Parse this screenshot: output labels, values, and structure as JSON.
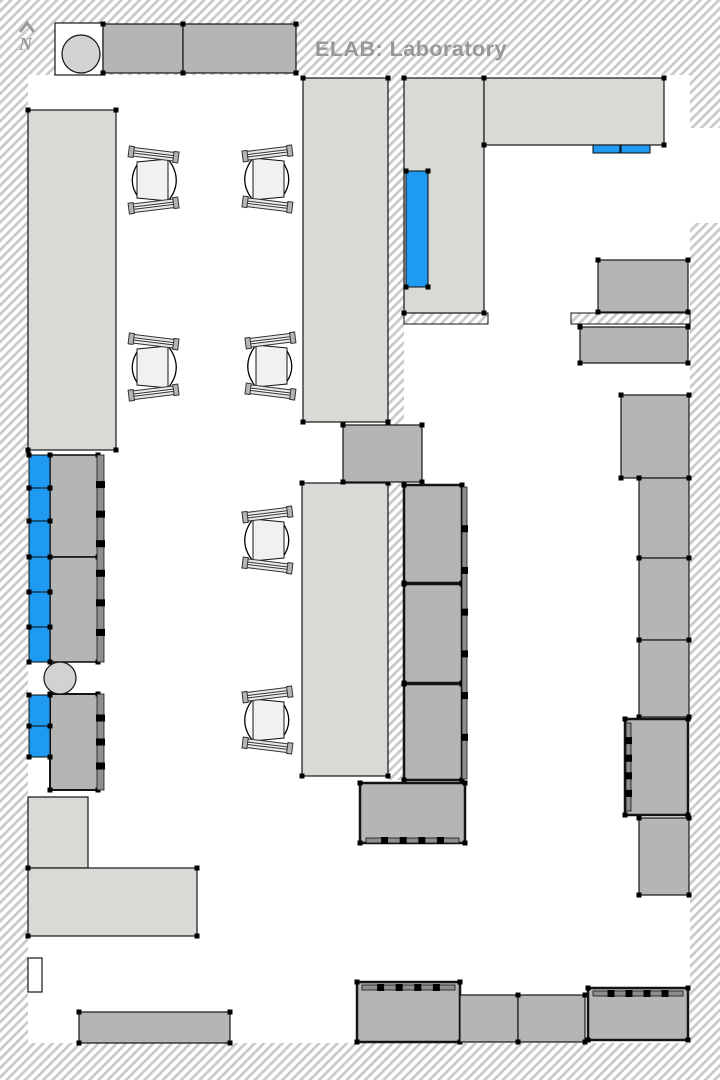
{
  "title": {
    "text": "ELAB: Laboratory"
  },
  "north": {
    "label": "N"
  },
  "palette": {
    "title_text": "#96989A",
    "north_gray": "#9B9B9B",
    "hatch_line": "#C9C9C9",
    "bench_light": "#D9D9D6",
    "equipment_gray": "#B5B5B3",
    "equipment_dark_strip": "#8F8F8D",
    "blue_unit": "#1E9BF0",
    "seat_fill": "#F1F1EF",
    "stool_fill": "#D2D2D0",
    "ink": "#141414"
  },
  "plan": {
    "items": [
      {
        "name": "wall-top",
        "t": "wall",
        "x": 0,
        "y": 0,
        "w": 720,
        "h": 75
      },
      {
        "name": "wall-left",
        "t": "wall",
        "x": 0,
        "y": 75,
        "w": 28,
        "h": 968
      },
      {
        "name": "wall-bottom",
        "t": "wall",
        "x": 0,
        "y": 1043,
        "w": 720,
        "h": 37
      },
      {
        "name": "wall-right-upper",
        "t": "wall",
        "x": 690,
        "y": 75,
        "w": 30,
        "h": 53
      },
      {
        "name": "wall-right-main",
        "t": "wall",
        "x": 690,
        "y": 223,
        "w": 30,
        "h": 820
      },
      {
        "name": "wall-center-upper",
        "t": "wall",
        "x": 388,
        "y": 75,
        "w": 16,
        "h": 350
      },
      {
        "name": "wall-center-lower",
        "t": "wall",
        "x": 388,
        "y": 483,
        "w": 16,
        "h": 297
      },
      {
        "name": "ledge-center",
        "t": "ledge",
        "x": 404,
        "y": 313,
        "w": 84,
        "h": 11
      },
      {
        "name": "ledge-right",
        "t": "ledge",
        "x": 571,
        "y": 313,
        "w": 119,
        "h": 11
      },
      {
        "name": "wall-notch-upper",
        "t": "notch",
        "x": 28,
        "y": 348,
        "w": 14,
        "h": 34
      },
      {
        "name": "wall-notch-lower",
        "t": "notch",
        "x": 28,
        "y": 958,
        "w": 14,
        "h": 34
      },
      {
        "name": "entry-nook",
        "t": "notch",
        "x": 55,
        "y": 23,
        "w": 48,
        "h": 52
      },
      {
        "name": "bench-left",
        "t": "bench",
        "x": 28,
        "y": 110,
        "w": 88,
        "h": 340,
        "marks": true
      },
      {
        "name": "bench-island-upper",
        "t": "bench",
        "x": 303,
        "y": 78,
        "w": 85,
        "h": 344,
        "marks": true
      },
      {
        "name": "bench-east-vertical",
        "t": "bench",
        "x": 404,
        "y": 78,
        "w": 80,
        "h": 235,
        "marks": true
      },
      {
        "name": "bench-top-horizontal",
        "t": "bench",
        "x": 484,
        "y": 78,
        "w": 180,
        "h": 67,
        "marks": true
      },
      {
        "name": "bench-island-lower",
        "t": "bench",
        "x": 302,
        "y": 483,
        "w": 86,
        "h": 293,
        "marks": true
      },
      {
        "name": "bench-southwest-strip",
        "t": "bench",
        "x": 28,
        "y": 797,
        "w": 60,
        "h": 71
      },
      {
        "name": "bench-southwest",
        "t": "bench",
        "x": 28,
        "y": 868,
        "w": 169,
        "h": 68,
        "marks": true
      },
      {
        "name": "cabinet-top-1",
        "t": "equip",
        "x": 103,
        "y": 24,
        "w": 80,
        "h": 49,
        "marks": true
      },
      {
        "name": "cabinet-top-2",
        "t": "equip",
        "x": 183,
        "y": 24,
        "w": 113,
        "h": 49,
        "marks": true
      },
      {
        "name": "equipment-left-upper",
        "t": "equip",
        "x": 50,
        "y": 455,
        "w": 48,
        "h": 102,
        "sw": 1.6,
        "marks": true
      },
      {
        "name": "equipment-left-middle",
        "t": "equip",
        "x": 50,
        "y": 557,
        "w": 48,
        "h": 105,
        "sw": 1.6,
        "marks": true
      },
      {
        "name": "equipment-left-edge-strip",
        "t": "dark",
        "x": 97,
        "y": 455,
        "w": 7,
        "h": 207,
        "dashes": 6
      },
      {
        "name": "equipment-left-lower",
        "t": "equip",
        "x": 50,
        "y": 694,
        "w": 48,
        "h": 96,
        "sw": 2,
        "marks": true
      },
      {
        "name": "equipment-left-lower-strip",
        "t": "dark",
        "x": 97,
        "y": 694,
        "w": 7,
        "h": 96,
        "dashes": 3
      },
      {
        "name": "equipment-center-pass",
        "t": "equip",
        "x": 343,
        "y": 425,
        "w": 79,
        "h": 57,
        "marks": true
      },
      {
        "name": "equipment-center-1",
        "t": "equip",
        "x": 404,
        "y": 485,
        "w": 58,
        "h": 98,
        "sw": 2.5,
        "marks": true
      },
      {
        "name": "equipment-center-2",
        "t": "equip",
        "x": 404,
        "y": 584,
        "w": 58,
        "h": 99,
        "sw": 2.5,
        "marks": true
      },
      {
        "name": "equipment-center-3",
        "t": "equip",
        "x": 404,
        "y": 684,
        "w": 58,
        "h": 96,
        "sw": 2.5,
        "marks": true
      },
      {
        "name": "equipment-center-edge-strip",
        "t": "dark",
        "x": 462,
        "y": 487,
        "w": 5,
        "h": 292,
        "dashes": 6
      },
      {
        "name": "equipment-center-south",
        "t": "equip",
        "x": 360,
        "y": 783,
        "w": 105,
        "h": 60,
        "sw": 2.5,
        "marks": true
      },
      {
        "name": "equipment-center-south-strip",
        "t": "dark",
        "x": 366,
        "y": 838,
        "w": 93,
        "h": 5,
        "dashes": 4
      },
      {
        "name": "equipment-right-top",
        "t": "equip",
        "x": 598,
        "y": 260,
        "w": 90,
        "h": 52,
        "marks": true
      },
      {
        "name": "equipment-right-ledge-block",
        "t": "equip",
        "x": 580,
        "y": 327,
        "w": 108,
        "h": 36,
        "marks": true
      },
      {
        "name": "equipment-right-1",
        "t": "equip",
        "x": 621,
        "y": 395,
        "w": 68,
        "h": 83,
        "marks": true
      },
      {
        "name": "equipment-right-2",
        "t": "equip",
        "x": 639,
        "y": 478,
        "w": 50,
        "h": 80,
        "marks": true
      },
      {
        "name": "equipment-right-3",
        "t": "equip",
        "x": 639,
        "y": 558,
        "w": 50,
        "h": 82,
        "marks": true
      },
      {
        "name": "equipment-right-4",
        "t": "equip",
        "x": 639,
        "y": 640,
        "w": 50,
        "h": 77,
        "marks": true
      },
      {
        "name": "equipment-right-5",
        "t": "equip",
        "x": 625,
        "y": 719,
        "w": 63,
        "h": 96,
        "sw": 2.5,
        "marks": true
      },
      {
        "name": "equipment-right-5-strip",
        "t": "dark",
        "x": 626,
        "y": 723,
        "w": 5,
        "h": 88,
        "dashes": 4
      },
      {
        "name": "equipment-right-6",
        "t": "equip",
        "x": 639,
        "y": 818,
        "w": 50,
        "h": 77,
        "marks": true
      },
      {
        "name": "equipment-south-1",
        "t": "equip",
        "x": 357,
        "y": 982,
        "w": 103,
        "h": 60,
        "sw": 2.5,
        "marks": true
      },
      {
        "name": "equipment-south-1-strip",
        "t": "dark",
        "x": 362,
        "y": 985,
        "w": 93,
        "h": 5,
        "dashes": 4
      },
      {
        "name": "equipment-south-2",
        "t": "equip",
        "x": 460,
        "y": 995,
        "w": 58,
        "h": 47
      },
      {
        "name": "equipment-south-3",
        "t": "equip",
        "x": 518,
        "y": 995,
        "w": 67,
        "h": 47,
        "marks": true
      },
      {
        "name": "equipment-south-4",
        "t": "equip",
        "x": 588,
        "y": 988,
        "w": 100,
        "h": 52,
        "sw": 2.5,
        "marks": true
      },
      {
        "name": "equipment-south-4-strip",
        "t": "dark",
        "x": 593,
        "y": 991,
        "w": 90,
        "h": 5,
        "dashes": 4
      },
      {
        "name": "equipment-southwest",
        "t": "equip",
        "x": 79,
        "y": 1012,
        "w": 151,
        "h": 31,
        "marks": true
      },
      {
        "name": "blue-unit-bench-east",
        "t": "blue",
        "x": 406,
        "y": 171,
        "w": 22,
        "h": 116,
        "marks": true
      },
      {
        "name": "blue-unit-top-a",
        "t": "blue",
        "x": 593,
        "y": 145,
        "w": 27,
        "h": 8
      },
      {
        "name": "blue-unit-top-b",
        "t": "blue",
        "x": 621,
        "y": 145,
        "w": 29,
        "h": 8
      },
      {
        "name": "blue-unit-left-1",
        "t": "blue",
        "x": 29,
        "y": 455,
        "w": 21,
        "h": 33,
        "marks": true
      },
      {
        "name": "blue-unit-left-2",
        "t": "blue",
        "x": 29,
        "y": 488,
        "w": 21,
        "h": 33,
        "marks": true
      },
      {
        "name": "blue-unit-left-3",
        "t": "blue",
        "x": 29,
        "y": 521,
        "w": 21,
        "h": 36,
        "marks": true
      },
      {
        "name": "blue-unit-left-4",
        "t": "blue",
        "x": 29,
        "y": 557,
        "w": 21,
        "h": 35,
        "marks": true
      },
      {
        "name": "blue-unit-left-5",
        "t": "blue",
        "x": 29,
        "y": 592,
        "w": 21,
        "h": 35,
        "marks": true
      },
      {
        "name": "blue-unit-left-6",
        "t": "blue",
        "x": 29,
        "y": 627,
        "w": 21,
        "h": 35,
        "marks": true
      },
      {
        "name": "blue-unit-left-7",
        "t": "blue",
        "x": 29,
        "y": 695,
        "w": 21,
        "h": 31,
        "marks": true
      },
      {
        "name": "blue-unit-left-8",
        "t": "blue",
        "x": 29,
        "y": 726,
        "w": 21,
        "h": 31,
        "marks": true
      },
      {
        "name": "stool-top",
        "t": "circle",
        "cx": 81,
        "cy": 54,
        "r": 19
      },
      {
        "name": "stool-left",
        "t": "circle",
        "cx": 60,
        "cy": 678,
        "r": 16
      },
      {
        "name": "chair-1",
        "t": "chair",
        "x": 126,
        "y": 144,
        "m": true
      },
      {
        "name": "chair-2",
        "t": "chair",
        "x": 240,
        "y": 143
      },
      {
        "name": "chair-3",
        "t": "chair",
        "x": 126,
        "y": 331,
        "m": true
      },
      {
        "name": "chair-4",
        "t": "chair",
        "x": 243,
        "y": 330
      },
      {
        "name": "chair-5",
        "t": "chair",
        "x": 240,
        "y": 504
      },
      {
        "name": "chair-6",
        "t": "chair",
        "x": 240,
        "y": 684
      }
    ]
  }
}
